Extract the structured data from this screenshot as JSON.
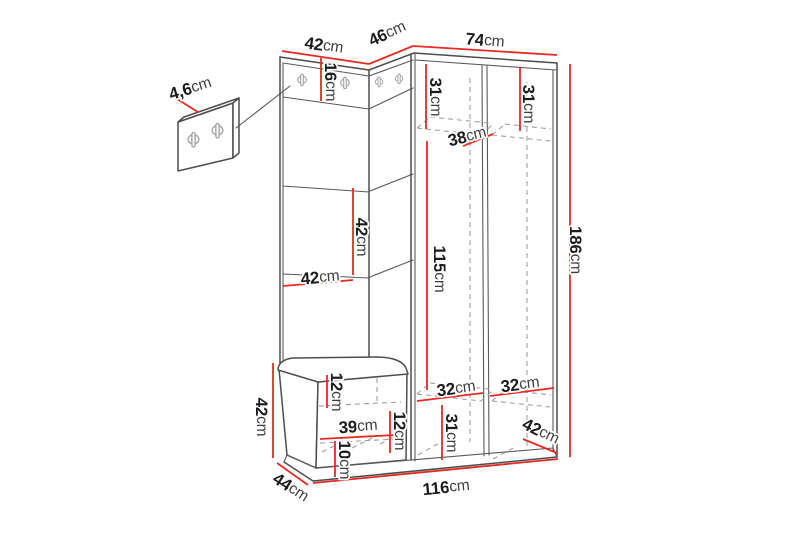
{
  "colors": {
    "dimension_line": "#e32b24",
    "outline": "#4d4d4d",
    "interior_dashed": "#9c9c9c",
    "hook_gray": "#a3a3a3",
    "background": "#ffffff"
  },
  "unit_of_measure": "cm",
  "dimensions": {
    "detail_panel_thickness": {
      "number": "4,6",
      "unit": "cm"
    },
    "left_panel_width_top": {
      "number": "42",
      "unit": "cm"
    },
    "corner_panel_width_top": {
      "number": "46",
      "unit": "cm"
    },
    "wardrobe_width_top": {
      "number": "74",
      "unit": "cm"
    },
    "hook_strip_height": {
      "number": "16",
      "unit": "cm"
    },
    "left_column_top_height": {
      "number": "31",
      "unit": "cm"
    },
    "right_column_top_height": {
      "number": "31",
      "unit": "cm"
    },
    "interior_depth": {
      "number": "38",
      "unit": "cm"
    },
    "panel_tile_height": {
      "number": "42",
      "unit": "cm"
    },
    "panel_width_mid": {
      "number": "42",
      "unit": "cm"
    },
    "hanging_space_height": {
      "number": "115",
      "unit": "cm"
    },
    "total_height": {
      "number": "186",
      "unit": "cm"
    },
    "seat_cushion_height": {
      "number": "12",
      "unit": "cm"
    },
    "drawer_width": {
      "number": "39",
      "unit": "cm"
    },
    "bench_bottom_height": {
      "number": "10",
      "unit": "cm"
    },
    "bench_right_height": {
      "number": "12",
      "unit": "cm"
    },
    "bench_height": {
      "number": "42",
      "unit": "cm"
    },
    "left_column_width": {
      "number": "32",
      "unit": "cm"
    },
    "right_column_width": {
      "number": "32",
      "unit": "cm"
    },
    "bottom_compartment_height": {
      "number": "31",
      "unit": "cm"
    },
    "wardrobe_depth": {
      "number": "42",
      "unit": "cm"
    },
    "bench_depth": {
      "number": "44",
      "unit": "cm"
    },
    "total_width": {
      "number": "116",
      "unit": "cm"
    }
  }
}
